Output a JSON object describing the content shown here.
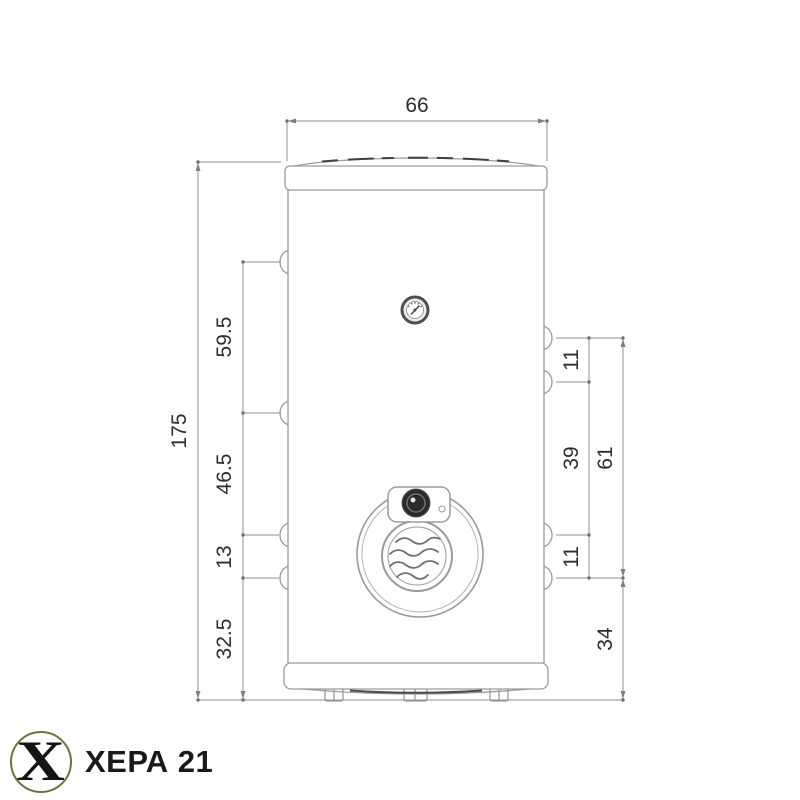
{
  "diagram": {
    "type": "technical-dimension-drawing",
    "subject": "cylindrical water heater (boiler), front view with overall and port dimensions",
    "dims": {
      "top_width": "66",
      "overall_height": "175",
      "left_segments": [
        "59.5",
        "46.5",
        "13",
        "32.5"
      ],
      "right_segments": [
        "11",
        "39",
        "11"
      ],
      "right_group": "61",
      "right_bottom_offset": "34"
    },
    "features": {
      "gauge_icon": "thermometer-dial-icon",
      "flange_icon": "heating-flange-with-thermostat-knob",
      "flange_logo_icon": "water-wave-icon",
      "left_ports": 4,
      "right_ports": 4
    },
    "colors": {
      "outline": "#9b9b9b",
      "dimension_line": "#8f8f8f",
      "text": "#2e2e2e",
      "dark_detail": "#3f3f3f",
      "logo_ring": "#6e7239",
      "brand_text": "#1a1a1a"
    }
  },
  "branding": {
    "logo_letter": "X",
    "brand_name": "ХЕРА 21"
  }
}
